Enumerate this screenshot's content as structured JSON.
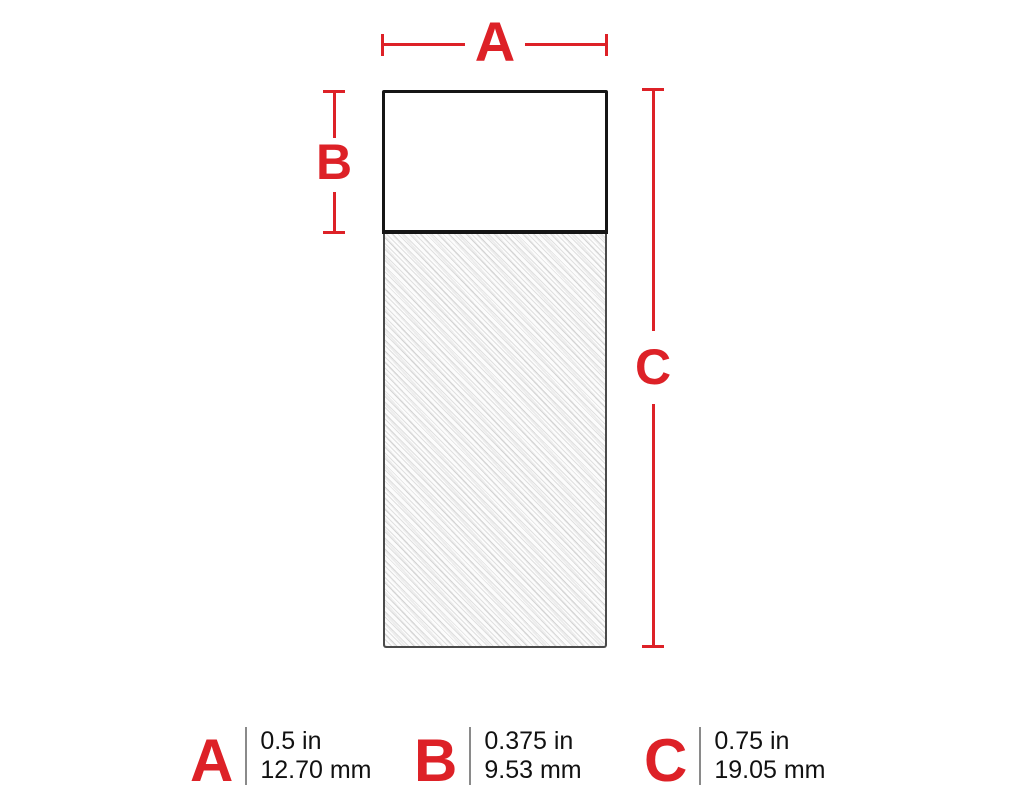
{
  "diagram": {
    "dim_a_label": "A",
    "dim_b_label": "B",
    "dim_c_label": "C",
    "label_parts": {
      "top_section": "printable-area",
      "bottom_section": "hatched-tail-area"
    }
  },
  "legend": {
    "items": [
      {
        "letter": "A",
        "inches": "0.5 in",
        "mm": "12.70 mm"
      },
      {
        "letter": "B",
        "inches": "0.375 in",
        "mm": "9.53 mm"
      },
      {
        "letter": "C",
        "inches": "0.75 in",
        "mm": "19.05 mm"
      }
    ]
  },
  "colors": {
    "accent_red": "#dd2127",
    "outline_black": "#161616",
    "hatch_outline_gray": "#4a4a4a",
    "legend_divider_gray": "#8a8a8a",
    "text_black": "#111111"
  }
}
